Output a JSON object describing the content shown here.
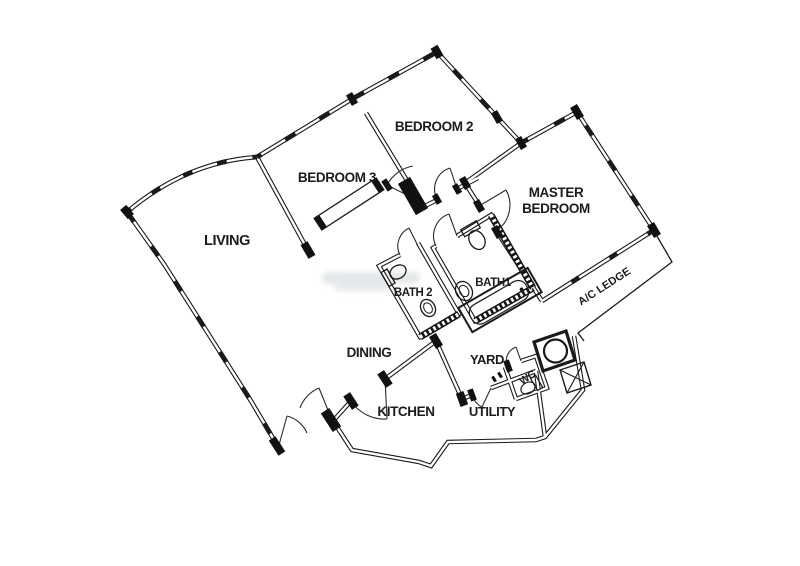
{
  "floor_plan": {
    "rooms": {
      "living": "LIVING",
      "bedroom3": "BEDROOM 3",
      "bedroom2": "BEDROOM 2",
      "master1": "MASTER",
      "master2": "BEDROOM",
      "bath2": "BATH 2",
      "bath1": "BATH1",
      "ac_ledge": "A/C LEDGE",
      "dining": "DINING",
      "yard": "YARD",
      "wc": "WC",
      "kitchen": "KITCHEN",
      "utility": "UTILITY"
    },
    "colors": {
      "line": "#1a1a1a",
      "background": "#ffffff"
    }
  }
}
